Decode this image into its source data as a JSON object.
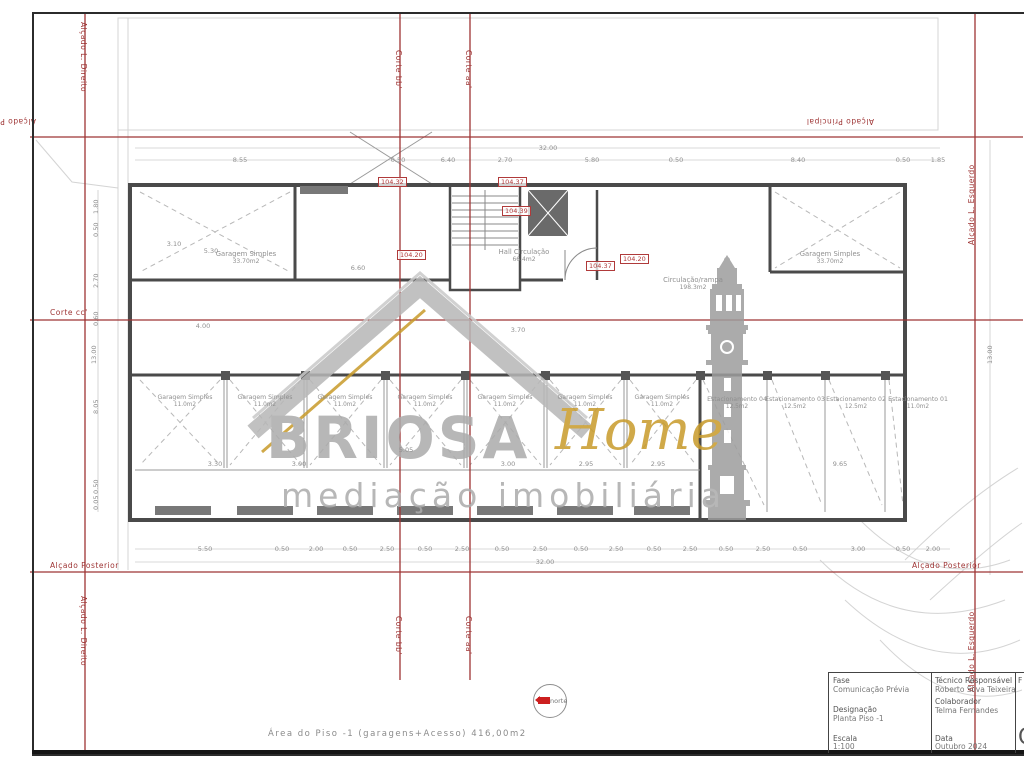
{
  "colors": {
    "section_red": "#9e3434",
    "level_red": "#b03a3a",
    "dim_gray": "#8f8f8f",
    "wall_gray": "#4a4a4a",
    "brand_gray": "#ababab",
    "brand_gold": "#c89b2a"
  },
  "watermark": {
    "brand": "BRIOSA",
    "brand_accent": "Home",
    "tagline": "mediação imobiliária"
  },
  "north": {
    "label": "norte"
  },
  "footer": {
    "area_note": "Área do Piso -1 (garagens+Acesso) 416,00m2"
  },
  "titleblock": {
    "fase_label": "Fase",
    "fase_value": "Comunicação Prévia",
    "designacao_label": "Designação",
    "designacao_value": "Planta Piso -1",
    "escala_label": "Escala",
    "escala_value": "1:100",
    "tecnico_label": "Técnico Responsável",
    "tecnico_value": "Roberto Silva Teixeira",
    "colaborador_label": "Colaborador",
    "colaborador_value": "Telma Fernandes",
    "data_label": "Data",
    "data_value": "Outubro 2024",
    "col3_top": "F",
    "col3_big": "C"
  },
  "section_labels": [
    {
      "text": "Alçado L. Direito",
      "x": 88,
      "y": 22,
      "rot": 90
    },
    {
      "text": "Corte bb'",
      "x": 403,
      "y": 50,
      "rot": 90
    },
    {
      "text": "Corte aa'",
      "x": 473,
      "y": 50,
      "rot": 90
    },
    {
      "text": "Alçado L. Esquerdo",
      "x": 967,
      "y": 245,
      "rot": -90
    },
    {
      "text": "Alçado Principal",
      "x": 36,
      "y": 126,
      "rot": 180
    },
    {
      "text": "Alçado Principal",
      "x": 874,
      "y": 126,
      "rot": 180
    },
    {
      "text": "Corte cc'",
      "x": 50,
      "y": 308,
      "rot": 0
    },
    {
      "text": "Alçado Posterior",
      "x": 50,
      "y": 561,
      "rot": 0
    },
    {
      "text": "Alçado Posterior",
      "x": 912,
      "y": 561,
      "rot": 0
    },
    {
      "text": "Alçado L. Direito",
      "x": 88,
      "y": 596,
      "rot": 90
    },
    {
      "text": "Corte bb'",
      "x": 403,
      "y": 616,
      "rot": 90
    },
    {
      "text": "Corte aa'",
      "x": 473,
      "y": 616,
      "rot": 90
    },
    {
      "text": "Alçado L. Esquerdo",
      "x": 967,
      "y": 692,
      "rot": -90
    }
  ],
  "levels": [
    {
      "value": "104.32",
      "x": 378,
      "y": 177
    },
    {
      "value": "104.37",
      "x": 498,
      "y": 177
    },
    {
      "value": "104.39",
      "x": 502,
      "y": 206
    },
    {
      "value": "104.20",
      "x": 397,
      "y": 250
    },
    {
      "value": "104.37",
      "x": 586,
      "y": 261
    },
    {
      "value": "104.20",
      "x": 620,
      "y": 254
    }
  ],
  "rooms": [
    {
      "name": "Garagem Simples",
      "area": "33.70m2",
      "x": 246,
      "y": 250
    },
    {
      "name": "Garagem Simples",
      "area": "33.70m2",
      "x": 830,
      "y": 250
    },
    {
      "name": "Hall Circulação",
      "area": "66.4m2",
      "x": 524,
      "y": 248
    },
    {
      "name": "Circulação/rampa",
      "area": "198.3m2",
      "x": 693,
      "y": 276
    }
  ],
  "garages": [
    {
      "name": "Garagem Simples",
      "area": "11.0m2",
      "x": 185,
      "y": 394
    },
    {
      "name": "Garagem Simples",
      "area": "11.0m2",
      "x": 265,
      "y": 394
    },
    {
      "name": "Garagem Simples",
      "area": "11.0m2",
      "x": 345,
      "y": 394
    },
    {
      "name": "Garagem Simples",
      "area": "11.0m2",
      "x": 425,
      "y": 394
    },
    {
      "name": "Garagem Simples",
      "area": "11.0m2",
      "x": 505,
      "y": 394
    },
    {
      "name": "Garagem Simples",
      "area": "11.0m2",
      "x": 585,
      "y": 394
    },
    {
      "name": "Garagem Simples",
      "area": "11.0m2",
      "x": 662,
      "y": 394
    }
  ],
  "parking": [
    {
      "name": "Estacionamento 04",
      "area": "12.5m2",
      "x": 737,
      "y": 396
    },
    {
      "name": "Estacionamento 03",
      "area": "12.5m2",
      "x": 795,
      "y": 396
    },
    {
      "name": "Estacionamento 02",
      "area": "12.5m2",
      "x": 856,
      "y": 396
    },
    {
      "name": "Estacionamento 01",
      "area": "11.0m2",
      "x": 918,
      "y": 396
    }
  ],
  "dimensions": {
    "top_overall": {
      "t": "32.00",
      "x": 548,
      "y": 144
    },
    "bottom_overall": {
      "t": "32.00",
      "x": 545,
      "y": 558
    },
    "top_chain": [
      {
        "t": "8.55",
        "x": 240,
        "y": 156
      },
      {
        "t": "0.50",
        "x": 398,
        "y": 156
      },
      {
        "t": "6.40",
        "x": 448,
        "y": 156
      },
      {
        "t": "2.70",
        "x": 505,
        "y": 156
      },
      {
        "t": "5.80",
        "x": 592,
        "y": 156
      },
      {
        "t": "0.50",
        "x": 676,
        "y": 156
      },
      {
        "t": "8.40",
        "x": 798,
        "y": 156
      },
      {
        "t": "0.50",
        "x": 903,
        "y": 156
      },
      {
        "t": "1.85",
        "x": 938,
        "y": 156
      }
    ],
    "bottom_chain": [
      {
        "t": "5.50",
        "x": 205,
        "y": 545
      },
      {
        "t": "0.50",
        "x": 282,
        "y": 545
      },
      {
        "t": "2.00",
        "x": 316,
        "y": 545
      },
      {
        "t": "0.50",
        "x": 350,
        "y": 545
      },
      {
        "t": "2.50",
        "x": 387,
        "y": 545
      },
      {
        "t": "0.50",
        "x": 425,
        "y": 545
      },
      {
        "t": "2.50",
        "x": 462,
        "y": 545
      },
      {
        "t": "0.50",
        "x": 502,
        "y": 545
      },
      {
        "t": "2.50",
        "x": 540,
        "y": 545
      },
      {
        "t": "0.50",
        "x": 581,
        "y": 545
      },
      {
        "t": "2.50",
        "x": 616,
        "y": 545
      },
      {
        "t": "0.50",
        "x": 654,
        "y": 545
      },
      {
        "t": "2.50",
        "x": 690,
        "y": 545
      },
      {
        "t": "0.50",
        "x": 726,
        "y": 545
      },
      {
        "t": "2.50",
        "x": 763,
        "y": 545
      },
      {
        "t": "0.50",
        "x": 800,
        "y": 545
      },
      {
        "t": "3.00",
        "x": 858,
        "y": 545
      },
      {
        "t": "0.50",
        "x": 903,
        "y": 545
      },
      {
        "t": "2.00",
        "x": 933,
        "y": 545
      }
    ],
    "left_chain": [
      {
        "t": "1.80",
        "x": 92,
        "y": 214,
        "rot": -90
      },
      {
        "t": "0.50",
        "x": 92,
        "y": 237,
        "rot": -90
      },
      {
        "t": "2.70",
        "x": 92,
        "y": 288,
        "rot": -90
      },
      {
        "t": "0.60",
        "x": 92,
        "y": 326,
        "rot": -90
      },
      {
        "t": "13.00",
        "x": 90,
        "y": 364,
        "rot": -90
      },
      {
        "t": "8.05",
        "x": 92,
        "y": 414,
        "rot": -90
      },
      {
        "t": "0.50",
        "x": 92,
        "y": 494,
        "rot": -90
      },
      {
        "t": "0.05",
        "x": 92,
        "y": 510,
        "rot": -90
      }
    ],
    "right_chain": [
      {
        "t": "13.00",
        "x": 986,
        "y": 364,
        "rot": -90
      }
    ],
    "inner": [
      {
        "t": "3.10",
        "x": 174,
        "y": 240,
        "rot": -90
      },
      {
        "t": "5.30",
        "x": 211,
        "y": 247
      },
      {
        "t": "6.60",
        "x": 358,
        "y": 264
      },
      {
        "t": "4.00",
        "x": 203,
        "y": 322
      },
      {
        "t": "3.70",
        "x": 518,
        "y": 326
      },
      {
        "t": "5.05",
        "x": 406,
        "y": 446
      },
      {
        "t": "3.30",
        "x": 215,
        "y": 460
      },
      {
        "t": "3.00",
        "x": 299,
        "y": 460
      },
      {
        "t": "3.00",
        "x": 508,
        "y": 460
      },
      {
        "t": "2.95",
        "x": 586,
        "y": 460
      },
      {
        "t": "2.95",
        "x": 658,
        "y": 460
      },
      {
        "t": "9.65",
        "x": 840,
        "y": 460
      }
    ]
  }
}
